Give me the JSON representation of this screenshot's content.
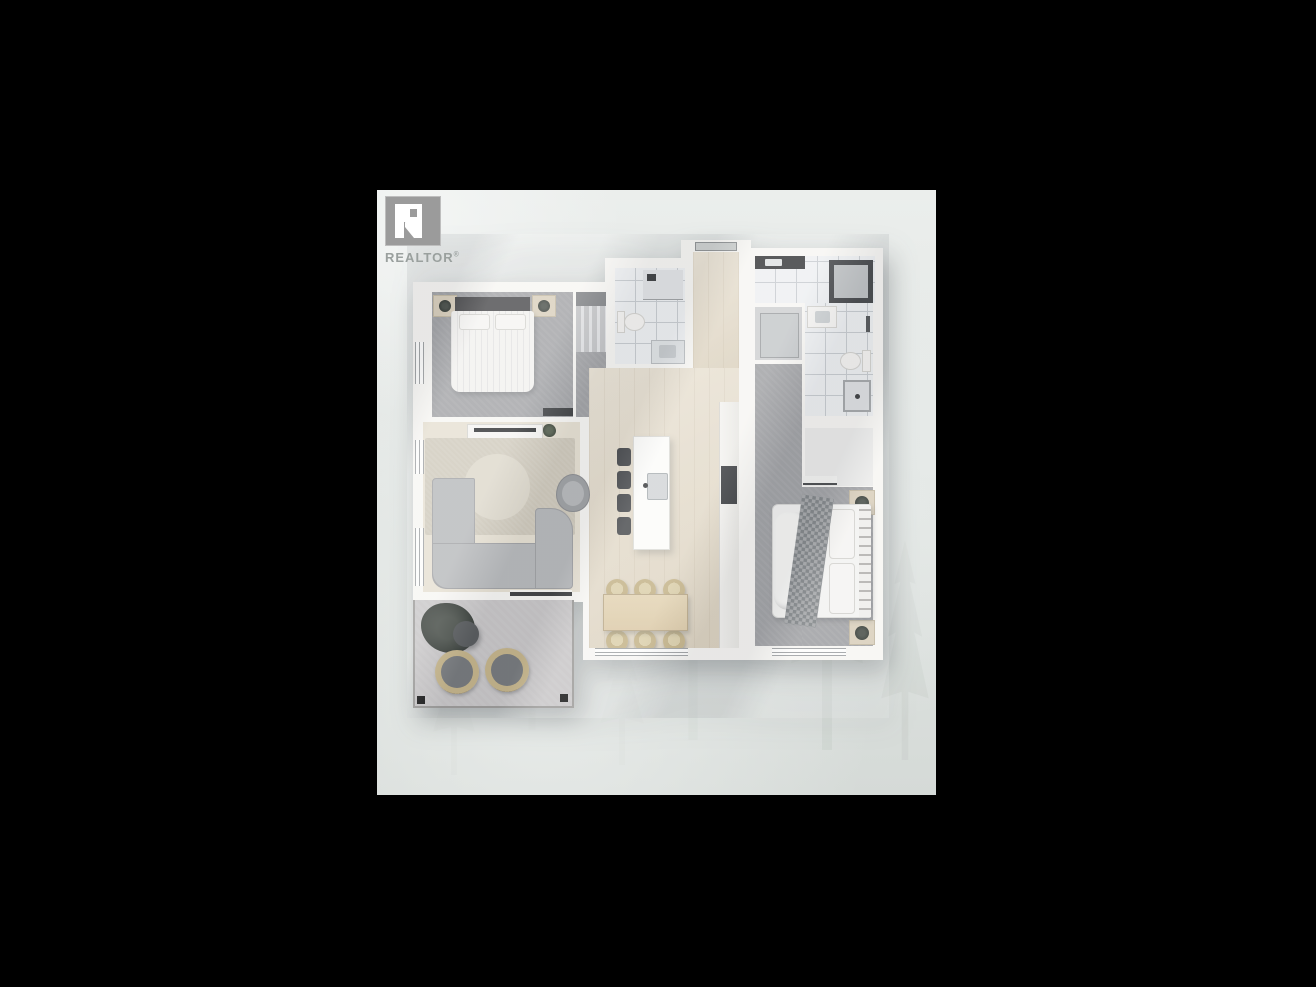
{
  "photo": {
    "watermark": {
      "brand": "REALTOR",
      "reg": "®"
    },
    "scene": "2-bedroom-apartment-floor-plan-render",
    "background": "misty-evergreen-forest"
  },
  "colors": {
    "canvas": "#000000",
    "bg_top": "#ebeeec",
    "bg_bottom": "#d5dad7",
    "wall": "#f7f6f3",
    "wood": "#e4dbc9",
    "carpet": "#a1a2a5",
    "tile": "#eef0f2",
    "tile_line": "#c8ccd0",
    "rug": "#cfc9bb",
    "sofa": "#b7b9bb",
    "concrete": "#c7c5c6",
    "dark": "#3e4042",
    "beige": "#d9cfbc",
    "table": "#dccaa8",
    "wicker": "#c4b388",
    "white_furn": "#f5f4f2",
    "logo": "#9b9b9b",
    "logo_text": "#9aa09e",
    "tree": "#9fab9f"
  }
}
